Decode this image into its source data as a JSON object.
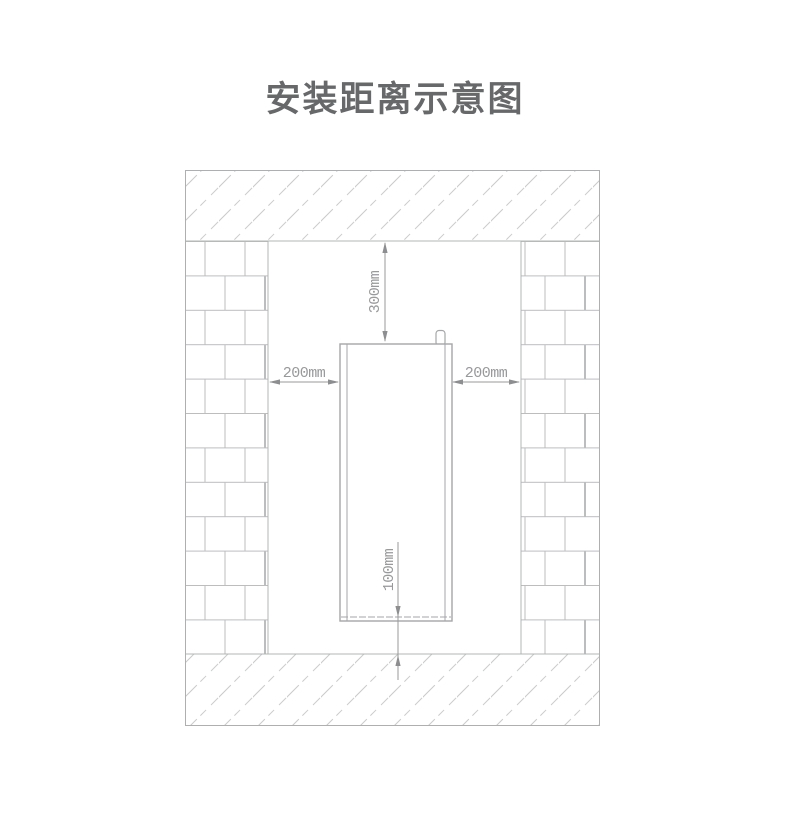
{
  "page": {
    "title": "安装距离示意图",
    "background": "#ffffff"
  },
  "diagram": {
    "type": "installation-clearance-schematic",
    "clearances": {
      "top": "300mm",
      "left": "200mm",
      "right": "200mm",
      "bottom": "100mm"
    },
    "colors": {
      "title_text": "#67686a",
      "wall_line": "#b3b4b6",
      "brick_line": "#bcbdbf",
      "hatch_line": "#c9cacc",
      "appliance_outline": "#a5a6a8",
      "dimension_line": "#98999b",
      "dimension_arrow": "#8d8e90",
      "dimension_text": "#98999b"
    }
  }
}
